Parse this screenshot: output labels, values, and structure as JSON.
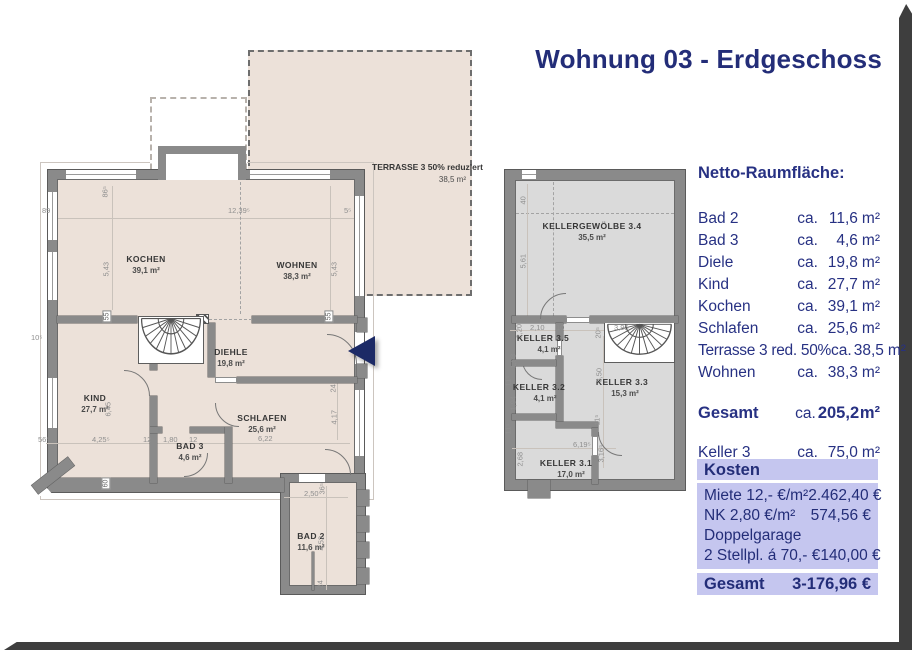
{
  "title": "Wohnung 03 - Erdgeschoss",
  "area_list": {
    "heading": "Netto-Raumfläche:",
    "prefix": "ca.",
    "unit": "m²",
    "rows": [
      {
        "label": "Bad 2",
        "amount": "11,6"
      },
      {
        "label": "Bad 3",
        "amount": "4,6"
      },
      {
        "label": "Diele",
        "amount": "19,8"
      },
      {
        "label": "Kind",
        "amount": "27,7"
      },
      {
        "label": "Kochen",
        "amount": "39,1"
      },
      {
        "label": "Schlafen",
        "amount": "25,6"
      },
      {
        "label": "Terrasse 3 red. 50%",
        "amount": "38,5"
      },
      {
        "label": "Wohnen",
        "amount": "38,3"
      }
    ],
    "total": {
      "label": "Gesamt",
      "amount": "205,2"
    },
    "keller": {
      "label": "Keller 3",
      "amount": "75,0"
    }
  },
  "kosten": {
    "heading": "Kosten",
    "rows": [
      {
        "label": "Miete 12,- €/m²",
        "value": "2.462,40 €"
      },
      {
        "label": "NK 2,80 €/m²",
        "value": "574,56 €"
      },
      {
        "label": "Doppelgarage",
        "value": ""
      },
      {
        "label": "2 Stellpl. á 70,- €",
        "value": "140,00 €"
      }
    ],
    "total": {
      "label": "Gesamt",
      "value": "3-176,96 €"
    }
  },
  "plan_main": {
    "terrace": {
      "name": "TERRASSE 3 50% reduziert",
      "area": "38,5 m²"
    },
    "rooms": [
      {
        "name": "KOCHEN",
        "area": "39,1 m²"
      },
      {
        "name": "WOHNEN",
        "area": "38,3 m²"
      },
      {
        "name": "DIEHLE",
        "area": "19,8 m²"
      },
      {
        "name": "KIND",
        "area": "27,7 m²"
      },
      {
        "name": "SCHLAFEN",
        "area": "25,6 m²"
      },
      {
        "name": "BAD 3",
        "area": "4,6 m²"
      },
      {
        "name": "BAD 2",
        "area": "11,6 m²"
      }
    ],
    "dims": [
      "12,39⁵",
      "5,43",
      "5,43",
      "86⁵",
      "89",
      "5⁵",
      "55",
      "55",
      "6,45",
      "4,25⁵",
      "12",
      "1,80",
      "12",
      "6,22",
      "4,17",
      "24",
      "56⁵",
      "2,50",
      "36⁵",
      "4,52",
      "24",
      "60",
      "10⁵"
    ]
  },
  "plan_keller": {
    "rooms": [
      {
        "name": "KELLERGEWÖLBE 3.4",
        "area": "35,5 m²"
      },
      {
        "name": "KELLER 3.5",
        "area": "4,1 m²"
      },
      {
        "name": "KELLER 3.2",
        "area": "4,1 m²"
      },
      {
        "name": "KELLER 3.3",
        "area": "15,3 m²"
      },
      {
        "name": "KELLER 3.1",
        "area": "17,0 m²"
      }
    ],
    "dims": [
      "40",
      "5,61",
      "2,20",
      "2,10",
      "10",
      "20⁵",
      "3,95",
      "1,93",
      "11⁵",
      "1,94",
      "11⁵",
      "2,68",
      "6,19⁵",
      "3,16⁵",
      "3,50",
      "11⁵"
    ]
  },
  "colors": {
    "accent_navy": "#232d78",
    "lavender": "#c5c6ef",
    "floor_beige": "#ece1d9",
    "floor_grey": "#dadada",
    "wall_grey": "#8a8a8a"
  }
}
